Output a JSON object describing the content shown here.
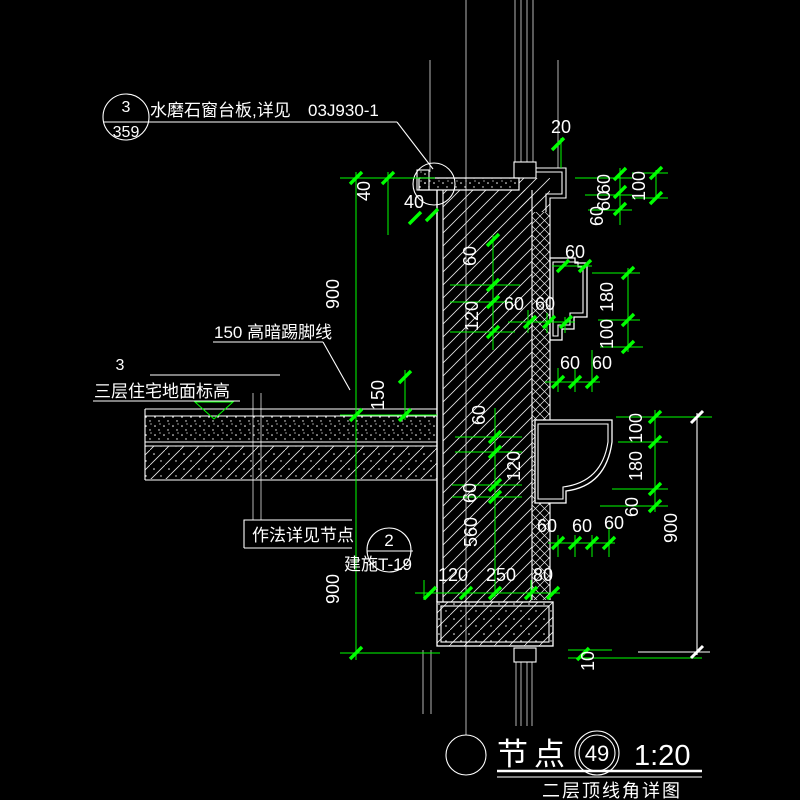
{
  "labels": {
    "callout_top": {
      "num": "3",
      "sheet": "359",
      "text": "水磨石窗台板,详见",
      "code": "03J930-1"
    },
    "skirting_note": "150 高暗踢脚线",
    "level": {
      "num": "3",
      "text": "三层住宅地面标高"
    },
    "method_note": "作法详见节点",
    "callout_mid": {
      "num": "2",
      "sheet": "建施T-19"
    },
    "title": {
      "name": "节点",
      "num": "49",
      "scale": "1:20",
      "subtitle": "二层顶线角详图"
    }
  },
  "dims": {
    "a40_v": "40",
    "a40_h": "40",
    "a20": "20",
    "left_900_top": "900",
    "skirt_150": "150",
    "left_900_bot": "900",
    "wall_60_1": "60",
    "wall_120_1": "120",
    "wall_60_2": "60",
    "wall_120_2": "120",
    "wall_60_3": "60",
    "wall_560": "560",
    "step_60_1": "60",
    "step_60_2": "60",
    "step_60_3": "60",
    "step_60_4": "60",
    "low_60_1": "60",
    "low_60_2": "60",
    "low_60_3": "60",
    "bot_120": "120",
    "bot_250": "250",
    "bot_80": "80",
    "r_60_1": "60",
    "r_60_2": "60",
    "r_60_3": "60",
    "r_100_1": "100",
    "cornice_60": "60",
    "r_180_1": "180",
    "r_100_2": "100",
    "r_100_3": "100",
    "r_180_2": "180",
    "r_60_4": "60",
    "r_900": "900",
    "r_10": "10"
  },
  "colors": {
    "background": "#000000",
    "line": "#ffffff",
    "dimension": "#00ff00"
  }
}
